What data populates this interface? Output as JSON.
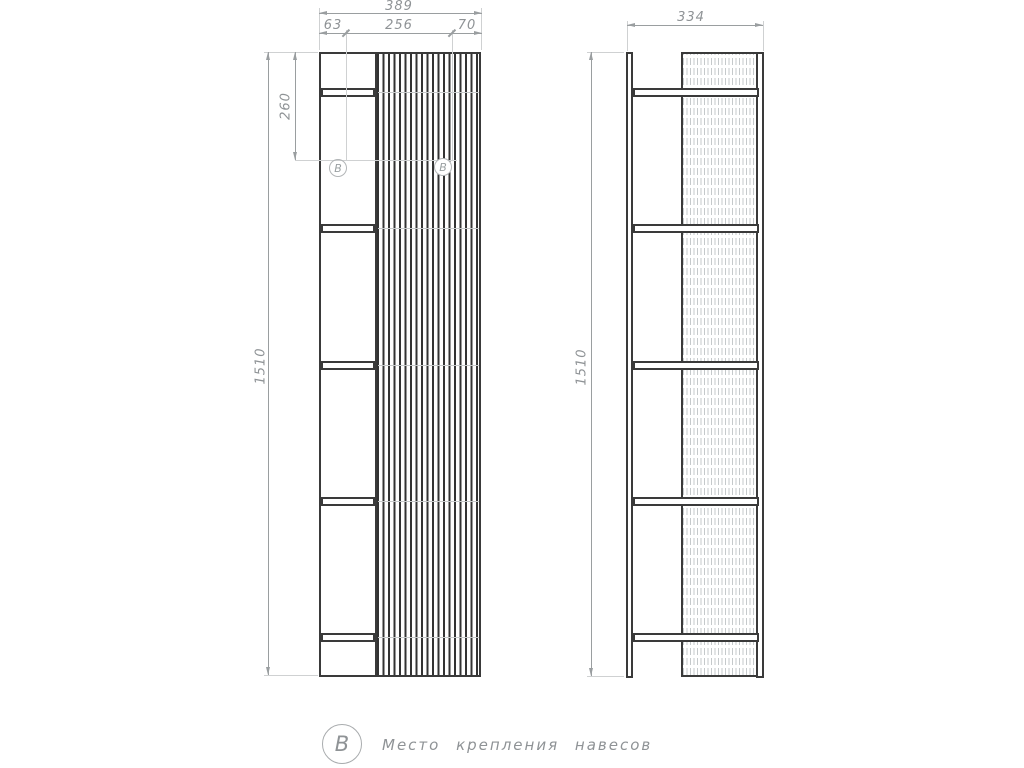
{
  "front_view": {
    "width_total": "389",
    "width_segments": [
      "63",
      "256",
      "70"
    ],
    "height": "1510",
    "attachment_height": "260",
    "attachment_marker": "B"
  },
  "side_view": {
    "depth": "334",
    "height": "1510"
  },
  "legend": {
    "marker": "B",
    "caption": "Место крепления навесов"
  },
  "colors": {
    "outline": "#3a3a3a",
    "dimension": "#9a9ea0"
  }
}
